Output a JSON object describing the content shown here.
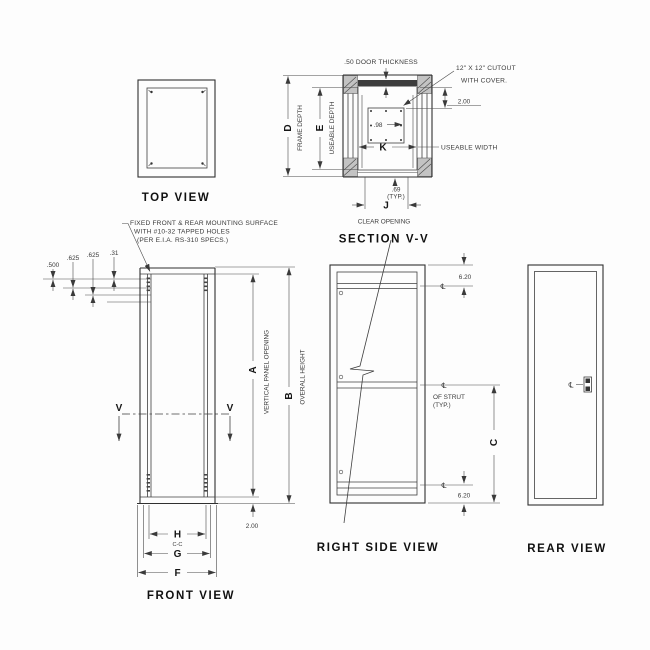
{
  "symbols": {
    "centerline": "℄"
  },
  "drawing": {
    "top_view": {
      "title": "TOP VIEW"
    },
    "section_vv": {
      "title": "SECTION V-V",
      "door_thickness_note": ".50 DOOR THICKNESS",
      "cutout_note_line1": "12\" X 12\" CUTOUT",
      "cutout_note_line2": "WITH COVER.",
      "dim_098": ".98",
      "dim_200": "2.00",
      "dim_k": "K",
      "useable_width_label": "USEABLE WIDTH",
      "dim_d": "D",
      "frame_depth_label": "FRAME DEPTH",
      "dim_e": "E",
      "useable_depth_label": "USEABLE DEPTH",
      "dim_69": ".69",
      "typ_label": "(TYP.)",
      "dim_j": "J",
      "clear_opening_label": "CLEAR OPENING"
    },
    "front_view": {
      "title": "FRONT VIEW",
      "mounting_note_line1": "FIXED FRONT & REAR MOUNTING SURFACE",
      "mounting_note_line2": "WITH #10-32 TAPPED HOLES",
      "mounting_note_line3": "(PER E.I.A. RS-310 SPECS.)",
      "dim_500": ".500",
      "dim_625a": ".625",
      "dim_625b": ".625",
      "dim_31": ".31",
      "section_cut_left": "V",
      "section_cut_right": "V",
      "dim_a": "A",
      "vertical_panel_opening_label": "VERTICAL PANEL OPENING",
      "dim_b": "B",
      "overall_height_label": "OVERALL HEIGHT",
      "dim_200": "2.00",
      "dim_h": "H",
      "center_to_center_label": "C-C",
      "dim_g": "G",
      "dim_f": "F"
    },
    "right_side_view": {
      "title": "RIGHT SIDE VIEW",
      "dim_620_top": "6.20",
      "dim_620_bottom": "6.20",
      "of_strut_line1": "OF STRUT",
      "of_strut_line2": "(TYP.)",
      "dim_c": "C"
    },
    "rear_view": {
      "title": "REAR VIEW"
    }
  },
  "colors": {
    "line": "#3a3a3a",
    "background": "#fdfdfd"
  }
}
